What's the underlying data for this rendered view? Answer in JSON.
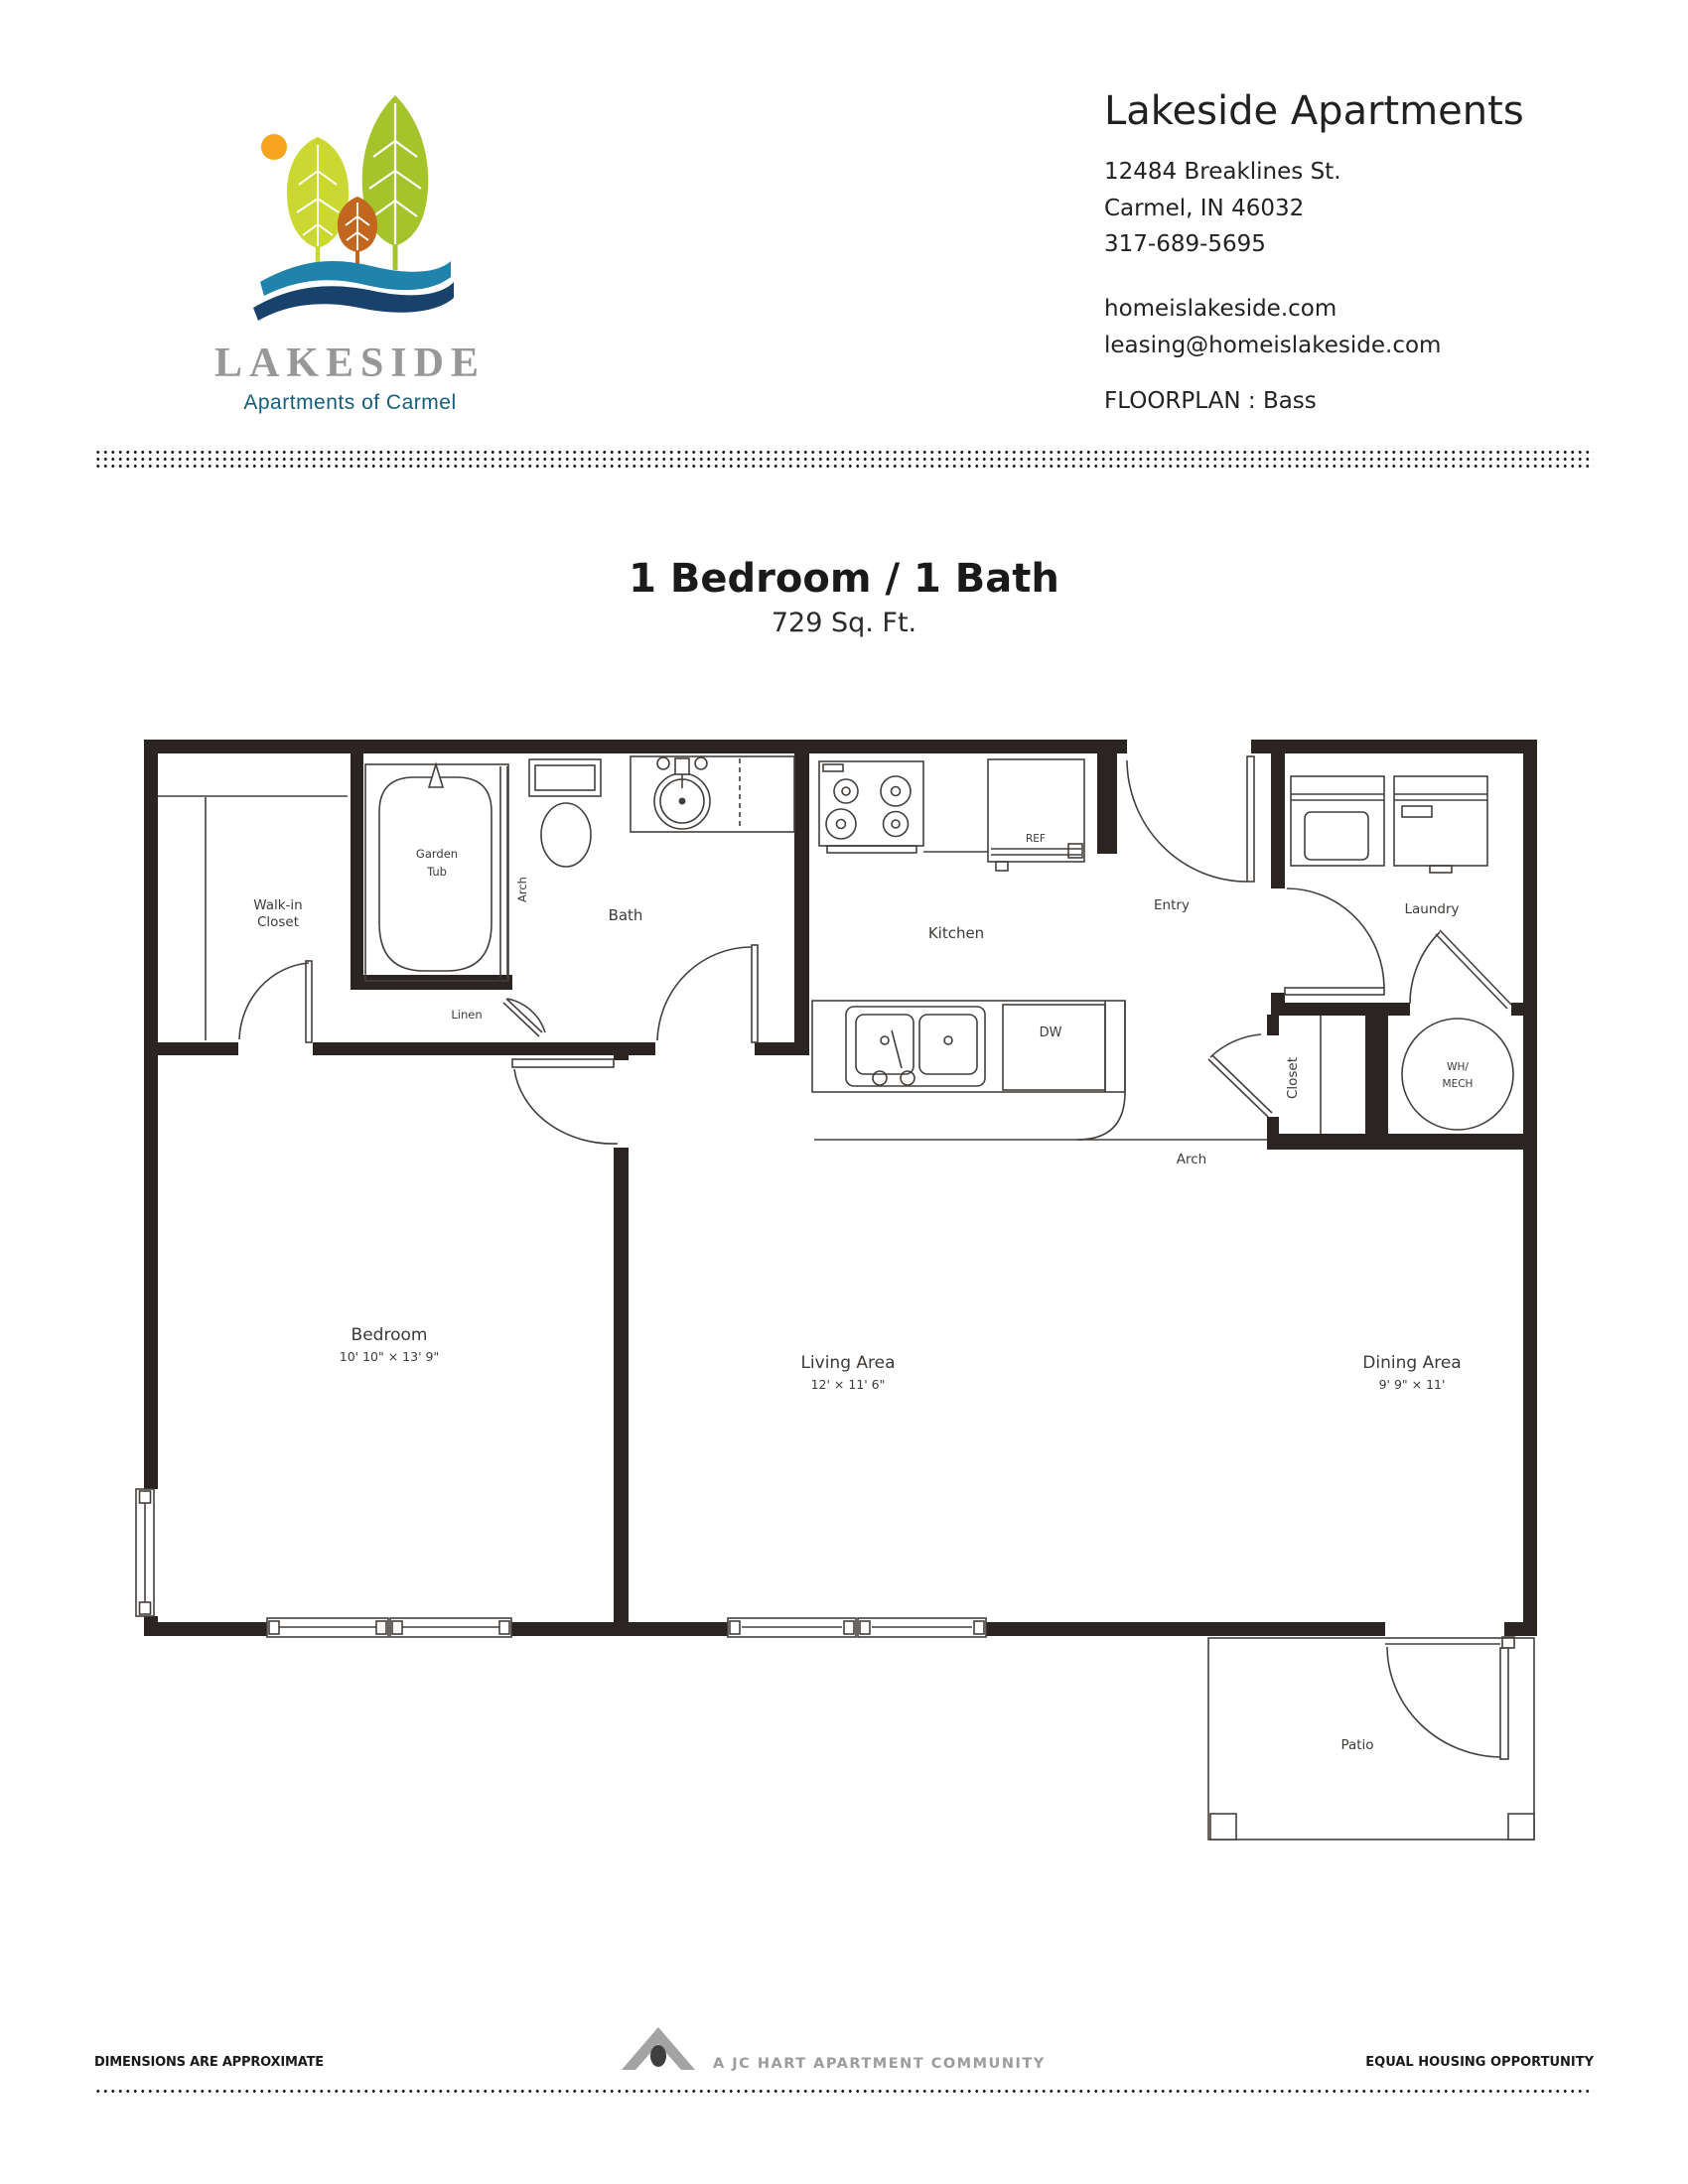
{
  "brand": {
    "name": "LAKESIDE",
    "tagline": "Apartments of Carmel",
    "lakeside_gray": "#97979a",
    "carmel_blue": "#155d7b",
    "wave_light": "#1f83ab",
    "wave_dark": "#18426b",
    "sun": "#f7a51f",
    "tree_light": "#ccd832",
    "tree_dark": "#a5c32b",
    "tree_orange": "#c2671f"
  },
  "header": {
    "title": "Lakeside Apartments",
    "address_line1": "12484 Breaklines St.",
    "address_line2": "Carmel, IN 46032",
    "phone": "317-689-5695",
    "website": "homeislakeside.com",
    "email": "leasing@homeislakeside.com",
    "floorplan_label": "FLOORPLAN :",
    "floorplan_name": "Bass"
  },
  "plan_title": {
    "heading": "1 Bedroom / 1 Bath",
    "area": "729 Sq. Ft."
  },
  "floorplan": {
    "rooms": {
      "bedroom": {
        "label": "Bedroom",
        "dims": "10' 10\" × 13' 9\""
      },
      "living": {
        "label": "Living Area",
        "dims": "12' × 11' 6\""
      },
      "dining": {
        "label": "Dining Area",
        "dims": "9' 9\" × 11'"
      },
      "kitchen": {
        "label": "Kitchen"
      },
      "bath": {
        "label": "Bath"
      },
      "entry": {
        "label": "Entry"
      },
      "laundry": {
        "label": "Laundry"
      },
      "walk_in_closet": {
        "line1": "Walk-in",
        "line2": "Closet"
      },
      "garden_tub": {
        "line1": "Garden",
        "line2": "Tub"
      },
      "linen": {
        "label": "Linen"
      },
      "closet": {
        "label": "Closet"
      },
      "wh_mech": {
        "line1": "WH/",
        "line2": "MECH"
      },
      "patio": {
        "label": "Patio"
      }
    },
    "annotations": {
      "arch_bath": "Arch",
      "arch_hall": "Arch",
      "ref": "REF",
      "dw": "DW"
    }
  },
  "footer": {
    "left": "DIMENSIONS ARE APPROXIMATE",
    "center": "A JC HART APARTMENT COMMUNITY",
    "right": "EQUAL HOUSING OPPORTUNITY"
  }
}
